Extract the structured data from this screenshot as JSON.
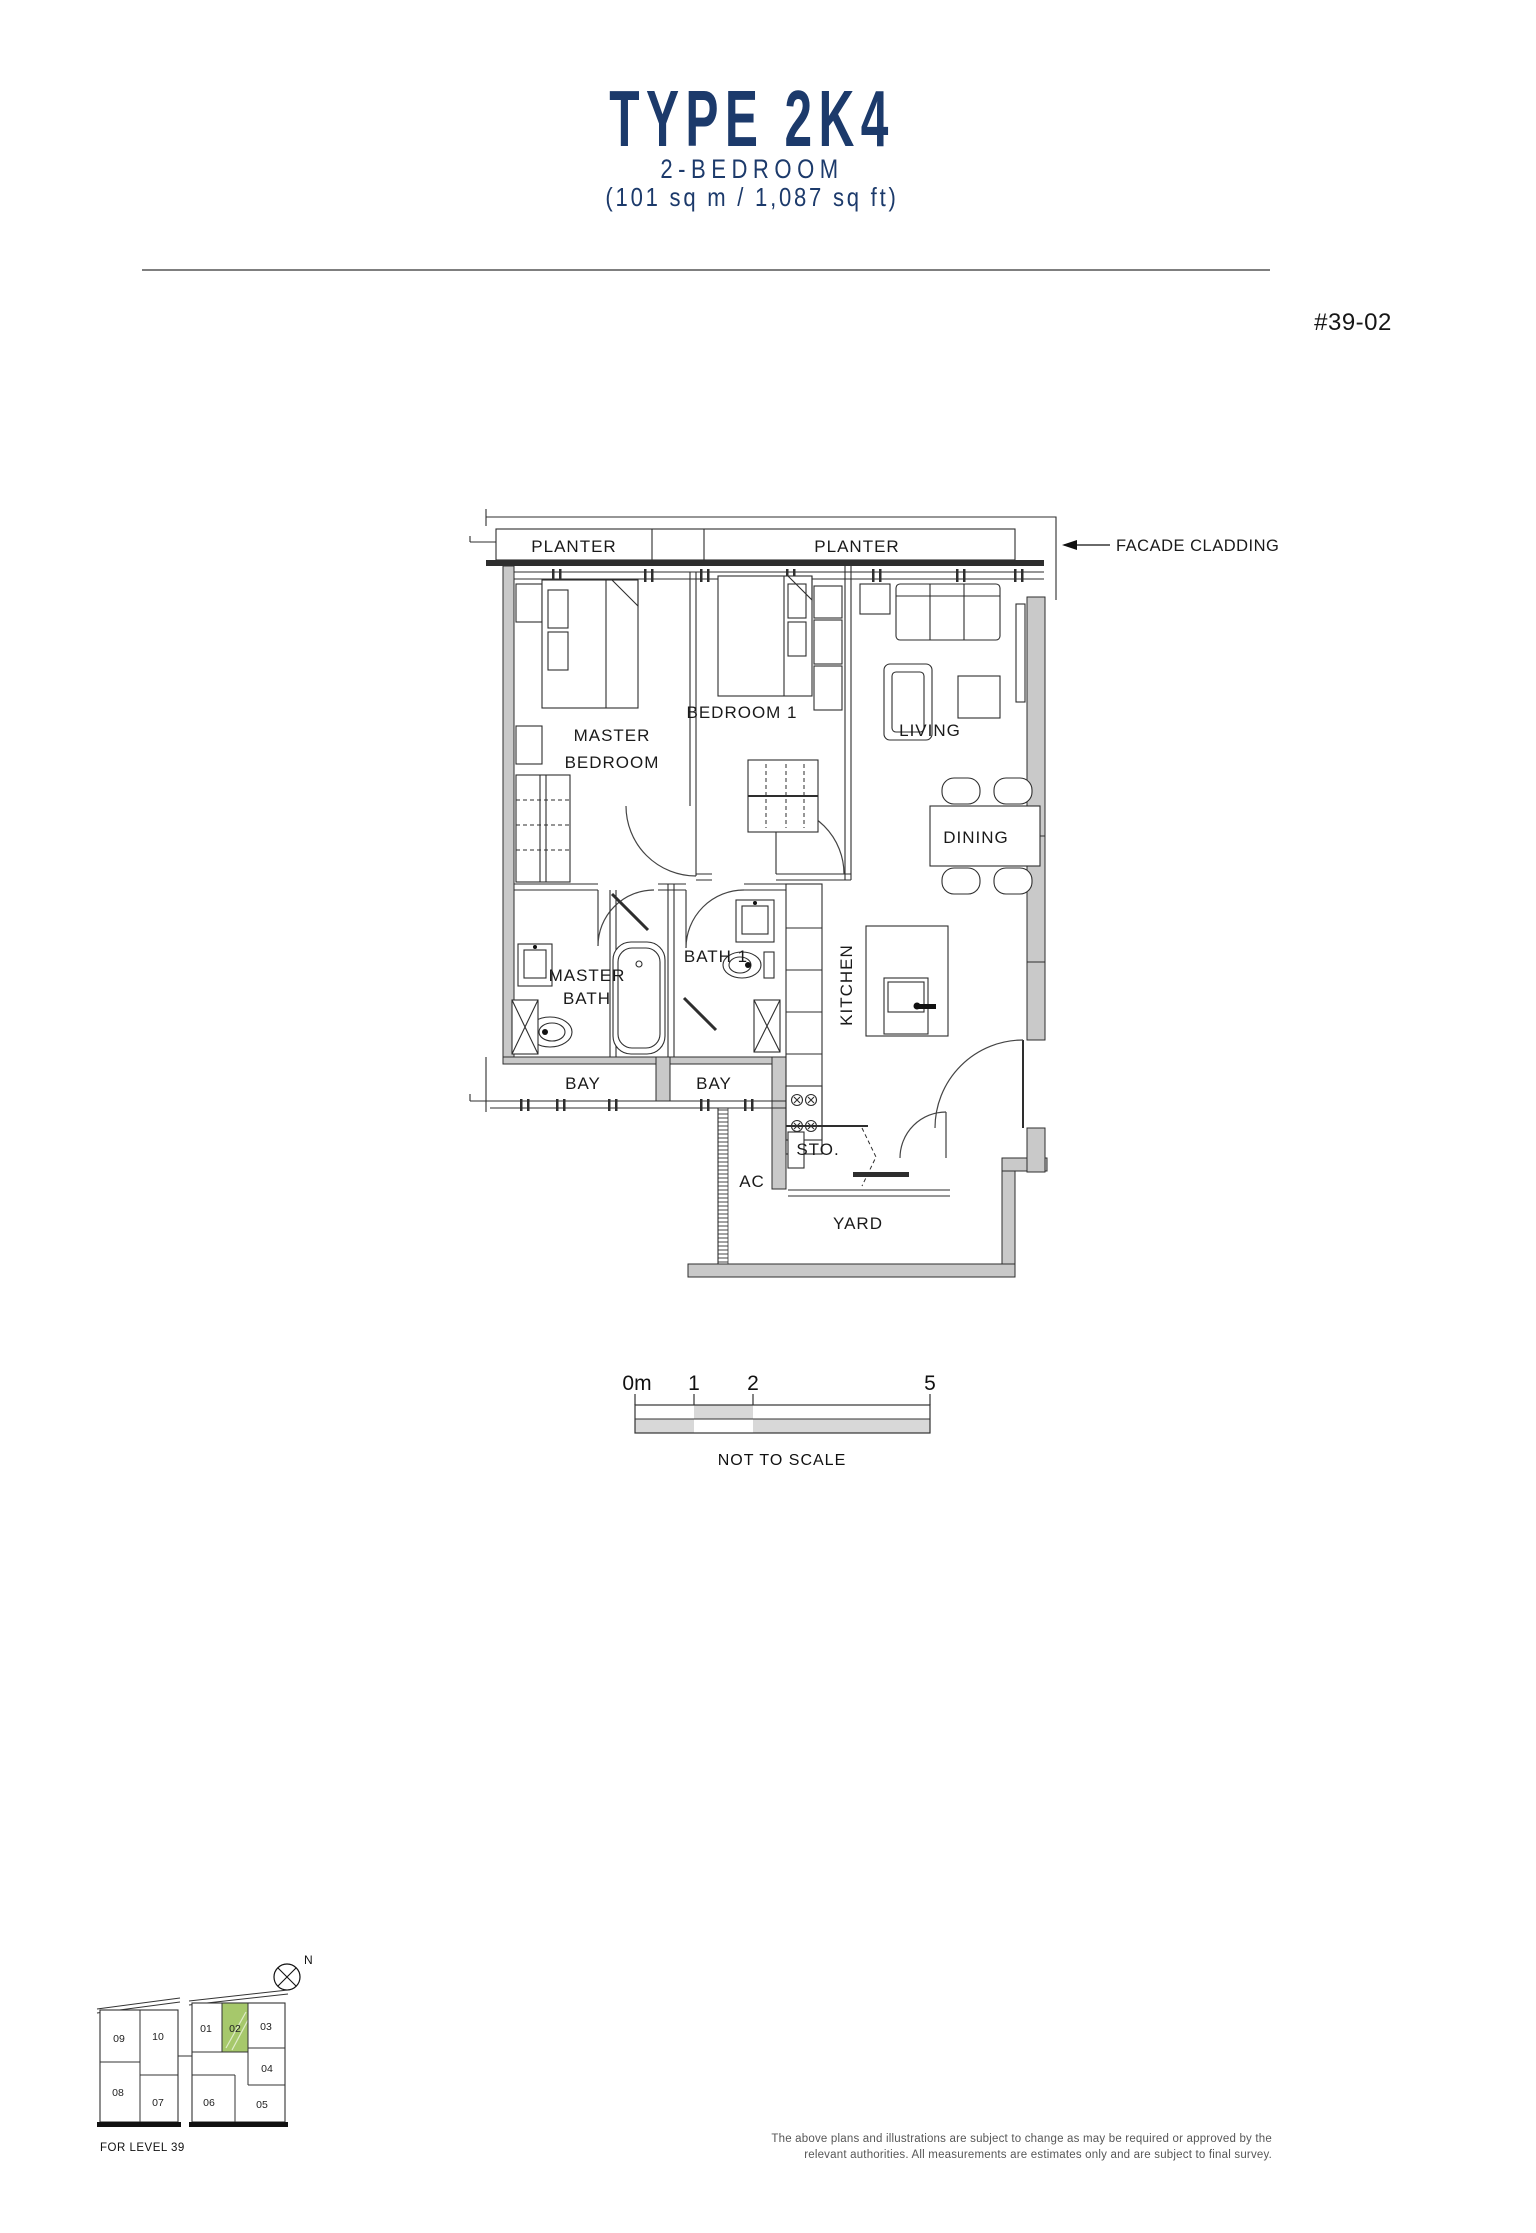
{
  "header": {
    "title": "TYPE 2K4",
    "subtitle": "2-BEDROOM",
    "area": "(101 sq m / 1,087 sq ft)"
  },
  "unit_label": "#39-02",
  "plan": {
    "planter_1": "PLANTER",
    "planter_2": "PLANTER",
    "facade_cladding": "FACADE CLADDING",
    "master_bedroom_1": "MASTER",
    "master_bedroom_2": "BEDROOM",
    "bedroom_1": "BEDROOM 1",
    "living": "LIVING",
    "dining": "DINING",
    "kitchen": "KITCHEN",
    "master_bath_1": "MASTER",
    "master_bath_2": "BATH",
    "bath_1": "BATH 1",
    "bay_1": "BAY",
    "bay_2": "BAY",
    "sto": "STO.",
    "ac": "AC",
    "yard": "YARD"
  },
  "scale_bar": {
    "tick_0": "0m",
    "tick_1": "1",
    "tick_2": "2",
    "tick_5": "5",
    "note": "NOT TO SCALE"
  },
  "key_plan": {
    "north": "N",
    "level_note": "FOR LEVEL 39",
    "highlighted_unit": "02",
    "highlight_color": "#a6c86b",
    "units": {
      "u01": "01",
      "u02": "02",
      "u03": "03",
      "u04": "04",
      "u05": "05",
      "u06": "06",
      "u07": "07",
      "u08": "08",
      "u09": "09",
      "u10": "10"
    }
  },
  "disclaimer": {
    "line1": "The above plans and illustrations are subject to change as may be required or approved by the",
    "line2": "relevant authorities. All measurements are estimates only and are subject to final survey."
  },
  "colors": {
    "navy": "#1c3a6b",
    "wall_gray": "#c9c9c9",
    "line_dark": "#2e2e2e"
  }
}
